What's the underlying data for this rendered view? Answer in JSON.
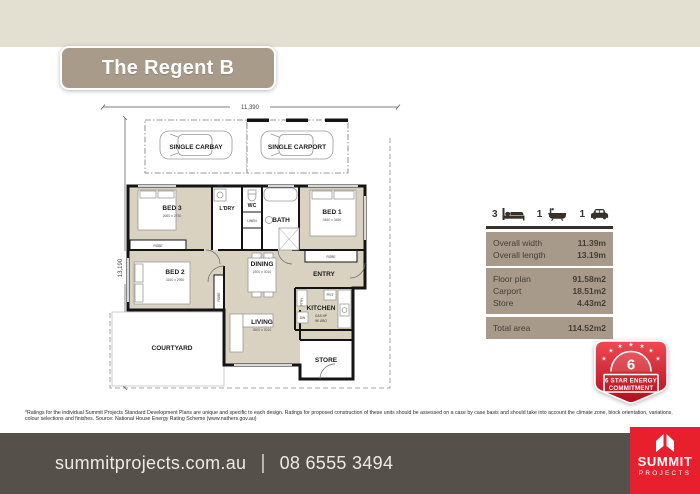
{
  "colors": {
    "cream": "#e3dfd1",
    "taupe_title": "#a89b8a",
    "table_bg": "#a79a8b",
    "footer_bg": "#56504b",
    "logo_red": "#e8202e",
    "badge_red": "#c81a28",
    "plan_room_fill": "#d9d2c0"
  },
  "title": {
    "text": "The Regent B"
  },
  "plan": {
    "dims": {
      "width": "11,390",
      "length": "13,190"
    },
    "rooms": {
      "carbay": {
        "label": "SINGLE CARBAY"
      },
      "carport": {
        "label": "SINGLE CARPORT"
      },
      "bed1": {
        "label": "BED 1",
        "dims": "3450 x 3450"
      },
      "bed2": {
        "label": "BED 2",
        "dims": "3150 x 2960"
      },
      "bed3": {
        "label": "BED 3",
        "dims": "2660 x 2730"
      },
      "dining": {
        "label": "DINING",
        "dims": "2500 x 3010"
      },
      "living": {
        "label": "LIVING",
        "dims": "3500 x 3010"
      },
      "kitchen": {
        "label": "KITCHEN",
        "note1": "GAS HP",
        "note2": "W/ UBO"
      },
      "entry": {
        "label": "ENTRY"
      },
      "bath": {
        "label": "BATH"
      },
      "wc": {
        "label": "WC"
      },
      "laundry": {
        "label": "L'DRY"
      },
      "store": {
        "label": "STORE"
      },
      "courtyard": {
        "label": "COURTYARD"
      }
    },
    "fixtures": {
      "robe": "ROBE",
      "linen": "LINEN",
      "wm": "WM",
      "pantry": "PTRY",
      "fridge": "FR'Z",
      "dw": "DW"
    }
  },
  "summary": {
    "features": [
      {
        "name": "bedrooms",
        "count": "3"
      },
      {
        "name": "bathrooms",
        "count": "1"
      },
      {
        "name": "carbays",
        "count": "1"
      }
    ],
    "rows1": [
      {
        "label": "Overall width",
        "value": "11.39m"
      },
      {
        "label": "Overall length",
        "value": "13.19m"
      }
    ],
    "rows2": [
      {
        "label": "Floor plan",
        "value": "91.58m2"
      },
      {
        "label": "Carport",
        "value": "18.51m2"
      },
      {
        "label": "Store",
        "value": "4.43m2"
      }
    ],
    "rows3": [
      {
        "label": "Total area",
        "value": "114.52m2"
      }
    ]
  },
  "badge": {
    "star": "★",
    "number": "6",
    "line1": "6 STAR ENERGY",
    "line2": "COMMITMENT"
  },
  "disclaimer": "*Ratings for the individual Summit Projects Standard Development Plans are unique and specific to each design. Ratings for proposed construction of these units should be assessed on a case by case basis and should take into account the climate zone, block orientation, variations, colour selections and finishes. Source: National House Energy Rating Scheme (www.nathers.gov.au)",
  "footer": {
    "website": "summitprojects.com.au",
    "divider": "|",
    "phone": "08 6555 3494",
    "logo_line1": "SUMMIT",
    "logo_line2": "PROJECTS"
  }
}
